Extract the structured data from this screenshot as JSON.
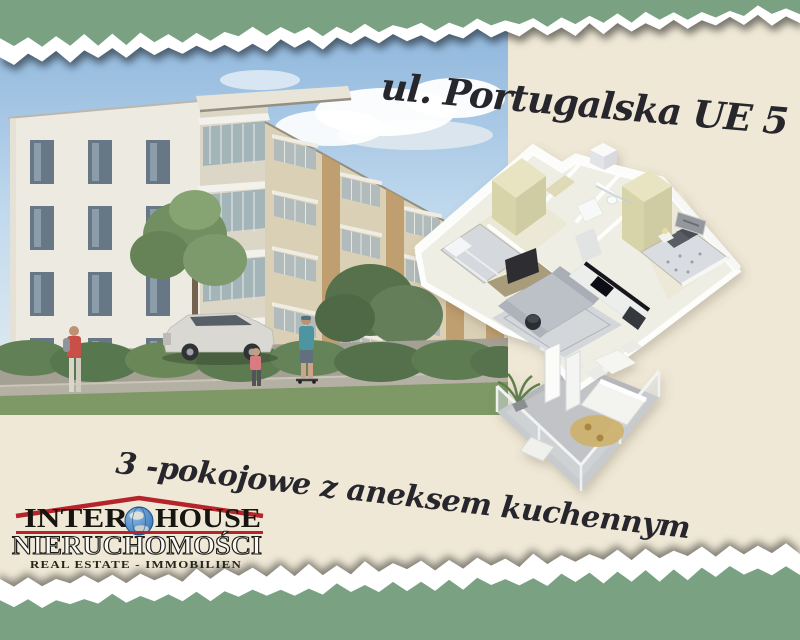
{
  "colors": {
    "background_green": "#7AA182",
    "paper_cream": "#EFE8D6",
    "logo_red": "#B5242B",
    "script_ink": "#26262C"
  },
  "address": {
    "text": "ul. Portugalska UE 5"
  },
  "tagline": {
    "text": "3 -pokojowe z aneksem kuchennym"
  },
  "logo": {
    "brand_left": "INTER",
    "brand_right": "HOUSE",
    "line2": "NIERUCHOMOŚCI",
    "line3": "REAL ESTATE - IMMOBILIEN"
  }
}
